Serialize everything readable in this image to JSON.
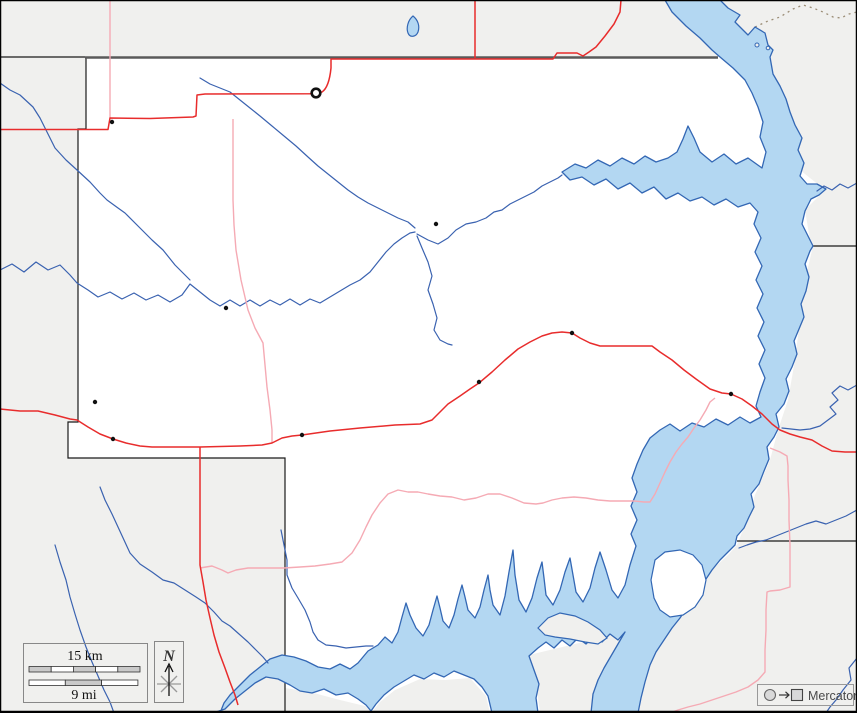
{
  "legend": {
    "scale_km_label": "15 km",
    "scale_mi_label": "9 mi",
    "north_label": "N"
  },
  "projection": {
    "label": "Mercator"
  },
  "copyright": {
    "text": "© d-maps.com"
  },
  "markers": {
    "town_count": 9,
    "county_seat_count": 1
  },
  "colors": {
    "county_fill": "#ffffff",
    "neighbor_fill": "#f0f0ee",
    "water_fill": "#b3d7f2",
    "water_stroke": "#3367b4",
    "stream": "#3a62b0",
    "road_primary": "#e82c2c",
    "road_secondary": "#f5aab4",
    "boundary": "#1a1a1a",
    "state_line": "#5a5a5a",
    "trail_dashed": "#9b8d76",
    "town_dot": "#111111"
  }
}
